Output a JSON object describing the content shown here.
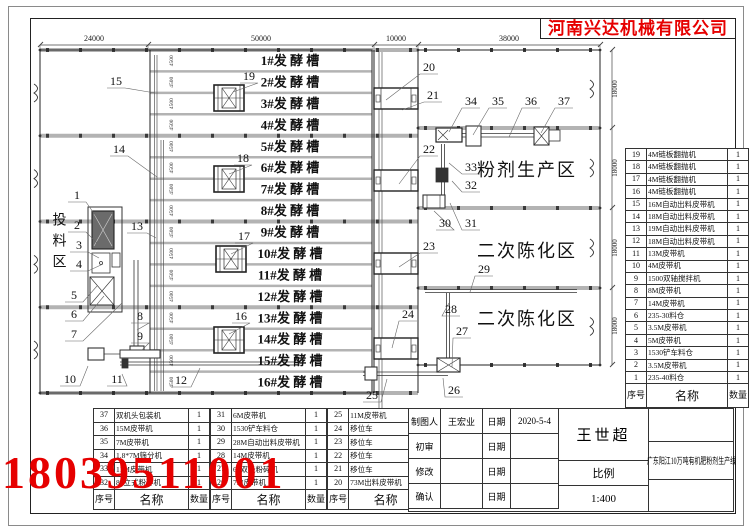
{
  "company": "河南兴达机械有限公司",
  "phone": "18039511001",
  "colors": {
    "accent_red": "#e60000",
    "line": "#2a2a2a",
    "rail": "#b3b3b3"
  },
  "dims": {
    "top": [
      "24000",
      "50000",
      "10000",
      "38000"
    ],
    "bay_right": "18000",
    "lane": "4500"
  },
  "areas": {
    "feeding": "投料区",
    "powder": "粉剂生产区",
    "aging_upper": "二次陈化区",
    "aging_lower": "二次陈化区"
  },
  "troughs": [
    "1#发 酵 槽",
    "2#发 酵 槽",
    "3#发 酵 槽",
    "4#发 酵 槽",
    "5#发 酵 槽",
    "6#发 酵 槽",
    "7#发 酵 槽",
    "8#发 酵 槽",
    "9#发 酵 槽",
    "10#发 酵 槽",
    "11#发 酵 槽",
    "12#发 酵 槽",
    "13#发 酵 槽",
    "14#发 酵 槽",
    "15#发 酵 槽",
    "16#发 酵 槽"
  ],
  "callouts": [
    "1",
    "2",
    "3",
    "4",
    "5",
    "6",
    "7",
    "8",
    "9",
    "10",
    "11",
    "12",
    "13",
    "14",
    "15",
    "16",
    "17",
    "18",
    "19",
    "20",
    "21",
    "22",
    "23",
    "24",
    "25",
    "26",
    "27",
    "28",
    "29",
    "30",
    "31",
    "32",
    "33",
    "34",
    "35",
    "36",
    "37"
  ],
  "bom_header": {
    "no": "序号",
    "name": "名称",
    "qty": "数量"
  },
  "right_table": {
    "rows": [
      {
        "no": "19",
        "name": "4M链板翻抛机",
        "qty": "1"
      },
      {
        "no": "18",
        "name": "4M链板翻抛机",
        "qty": "1"
      },
      {
        "no": "17",
        "name": "4M链板翻抛机",
        "qty": "1"
      },
      {
        "no": "16",
        "name": "4M链板翻抛机",
        "qty": "1"
      },
      {
        "no": "15",
        "name": "16M自动出料皮带机",
        "qty": "1"
      },
      {
        "no": "14",
        "name": "18M自动出料皮带机",
        "qty": "1"
      },
      {
        "no": "13",
        "name": "19M自动出料皮带机",
        "qty": "1"
      },
      {
        "no": "12",
        "name": "18M自动出料皮带机",
        "qty": "1"
      },
      {
        "no": "11",
        "name": "13M皮带机",
        "qty": "1"
      },
      {
        "no": "10",
        "name": "4M皮带机",
        "qty": "1"
      },
      {
        "no": "9",
        "name": "1500双轴搅拌机",
        "qty": "1"
      },
      {
        "no": "8",
        "name": "8M皮带机",
        "qty": "1"
      },
      {
        "no": "7",
        "name": "14M皮带机",
        "qty": "1"
      },
      {
        "no": "6",
        "name": "235-30料仓",
        "qty": "1"
      },
      {
        "no": "5",
        "name": "3.5M皮带机",
        "qty": "1"
      },
      {
        "no": "4",
        "name": "5M皮带机",
        "qty": "1"
      },
      {
        "no": "3",
        "name": "1530铲车料仓",
        "qty": "1"
      },
      {
        "no": "2",
        "name": "3.5M皮带机",
        "qty": "1"
      },
      {
        "no": "1",
        "name": "235-40料仓",
        "qty": "1"
      }
    ]
  },
  "bottom_table": {
    "groups": [
      [
        {
          "no": "37",
          "name": "双机头包装机",
          "qty": "1"
        },
        {
          "no": "36",
          "name": "15M皮带机",
          "qty": "1"
        },
        {
          "no": "35",
          "name": "7M皮带机",
          "qty": "1"
        },
        {
          "no": "34",
          "name": "1.8*7M筛分机",
          "qty": "1"
        },
        {
          "no": "33",
          "name": "11M皮带机",
          "qty": "1"
        },
        {
          "no": "32",
          "name": "80立式粉碎机",
          "qty": "1"
        }
      ],
      [
        {
          "no": "31",
          "name": "6M皮带机",
          "qty": "1"
        },
        {
          "no": "30",
          "name": "1530铲车料仓",
          "qty": "1"
        },
        {
          "no": "29",
          "name": "28M自动出料皮带机",
          "qty": "1"
        },
        {
          "no": "28",
          "name": "14M皮带机",
          "qty": "1"
        },
        {
          "no": "27",
          "name": "60双极粉碎机",
          "qty": "1"
        },
        {
          "no": "26",
          "name": "7M皮带机",
          "qty": "1"
        }
      ],
      [
        {
          "no": "25",
          "name": "11M皮带机",
          "qty": "1"
        },
        {
          "no": "24",
          "name": "移位车",
          "qty": "1"
        },
        {
          "no": "23",
          "name": "移位车",
          "qty": "1"
        },
        {
          "no": "22",
          "name": "移位车",
          "qty": "1"
        },
        {
          "no": "21",
          "name": "移位车",
          "qty": "1"
        },
        {
          "no": "20",
          "name": "73M出料皮带机",
          "qty": "1"
        }
      ]
    ]
  },
  "title_block": {
    "rows": [
      {
        "label": "制图人",
        "value": "王宏业",
        "date_label": "日期",
        "date": "2020-5-4"
      },
      {
        "label": "初审",
        "value": "",
        "date_label": "日期",
        "date": ""
      },
      {
        "label": "修改",
        "value": "",
        "date_label": "日期",
        "date": ""
      },
      {
        "label": "确认",
        "value": "",
        "date_label": "日期",
        "date": ""
      }
    ],
    "approver": "王世超",
    "scale_label": "比例",
    "scale": "1:400",
    "project": "广东阳江10万吨有机肥粉剂生产线"
  }
}
